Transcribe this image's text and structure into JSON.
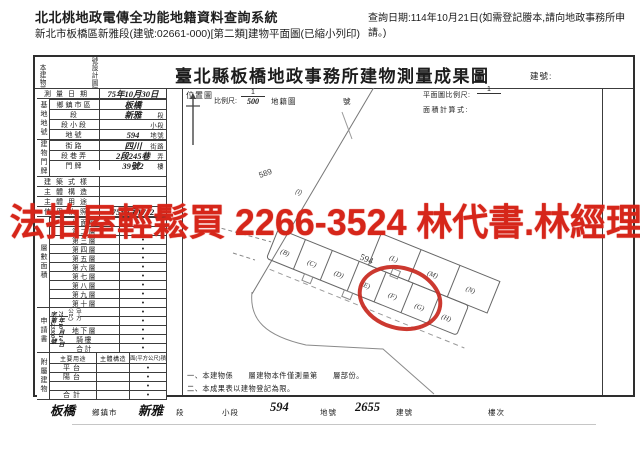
{
  "header": {
    "system_title": "北北桃地政電傳全功能地籍資料查詢系統",
    "print_info": "新北市板橋區新雅段(建號:02661-000)[第二類]建物平面圖(已縮小列印)",
    "query_date": "查詢日期:114年10月21日(如需登記謄本,請向地政事務所申請。)"
  },
  "watermark": {
    "text": "法拍屋輕鬆買 2266-3524 林代書.林經理",
    "color": "#d6261a"
  },
  "form": {
    "title": "臺北縣板橋地政事務所建物測量成果圖",
    "building_no_label": "建號:",
    "survey": {
      "label": "測量日期",
      "value": "75年10月30日"
    },
    "site": {
      "section_label": "基地地號",
      "rows": [
        {
          "label": "鄉鎮市區",
          "value": "板橋",
          "suffix": ""
        },
        {
          "label": "段",
          "value": "新雅",
          "suffix": "段"
        },
        {
          "label": "段小段",
          "value": "",
          "suffix": "小段"
        },
        {
          "label": "地號",
          "value": "594",
          "suffix": "地號"
        }
      ]
    },
    "address": {
      "section_label": "建物門牌",
      "rows": [
        {
          "label": "街路",
          "value": "四川",
          "suffix": "街路"
        },
        {
          "label": "段巷弄",
          "value": "2段245巷",
          "suffix": "弄"
        },
        {
          "label": "門牌",
          "value": "39號2",
          "suffix": "樓"
        }
      ]
    },
    "full_rows": [
      {
        "label": "建築式樣",
        "value": "",
        "suffix": ""
      },
      {
        "label": "主體構造",
        "value": "",
        "suffix": ""
      },
      {
        "label": "主體用途",
        "value": "",
        "suffix": ""
      },
      {
        "label": "使用執照",
        "value": "75使字1712",
        "suffix": "號"
      }
    ],
    "floors": {
      "section_label": "層數面積",
      "unit_label": "(平方公尺)",
      "rows": [
        "地面層",
        "第二層",
        "第三層",
        "第四層",
        "第五層",
        "第六層",
        "第七層",
        "第八層",
        "第九層",
        "第十層",
        "",
        "",
        "地下層",
        "騎樓"
      ],
      "total_label": "合計",
      "dot": "•"
    },
    "application": {
      "label": "申請書",
      "date": "75年10月14日",
      "number": "字第23300號"
    },
    "annex": {
      "section_label": "附屬建物",
      "headers": [
        "主要用途",
        "主體構造",
        "面(平方公尺)積"
      ],
      "rows": [
        "平台",
        "陽台",
        ""
      ],
      "total_label": "合計",
      "dot": "•"
    },
    "side_note_parts": [
      {
        "t": "本建物平面圖及建物面積依照"
      },
      {
        "t": "75",
        "h": true
      },
      {
        "t": "使字第"
      },
      {
        "t": "1712",
        "h": true
      },
      {
        "t": "號設計圖謄繪之平面圖轉繪計算"
      }
    ],
    "map": {
      "location_label": "位置圖",
      "scale_label": "比例尺:",
      "scale_num": "1",
      "scale_den": "500",
      "cadastre_label": "地籍圖",
      "cadastre_no_label": "號",
      "plan_scale_label": "平面圖比例尺:",
      "plan_scale_num": "1",
      "area_formula_label": "面積計算式:",
      "lot_589": "589",
      "lot_594": "594",
      "lot_i": "(I)",
      "parcels_bottom": [
        "(B)",
        "(C)",
        "(D)",
        "(E)",
        "(F)",
        "(G)",
        "(H)"
      ],
      "parcels_top": [
        "(L)",
        "(M)",
        "(N)"
      ],
      "highlight_color": "#c8281e"
    },
    "notes": [
      "一、本建物係　　層建物本件僅測量第　　層部份。",
      "二、本成果表以建物登記為限。"
    ]
  },
  "footer": {
    "items": [
      {
        "t": "板橋",
        "h": true
      },
      {
        "t": "鄉鎮市"
      },
      {
        "t": "新雅",
        "h": true
      },
      {
        "t": "段"
      },
      {
        "t": "小段"
      },
      {
        "t": "594",
        "h": true
      },
      {
        "t": "地號"
      },
      {
        "t": "2655",
        "h": true
      },
      {
        "t": "建號"
      },
      {
        "t": "樓次"
      }
    ]
  }
}
